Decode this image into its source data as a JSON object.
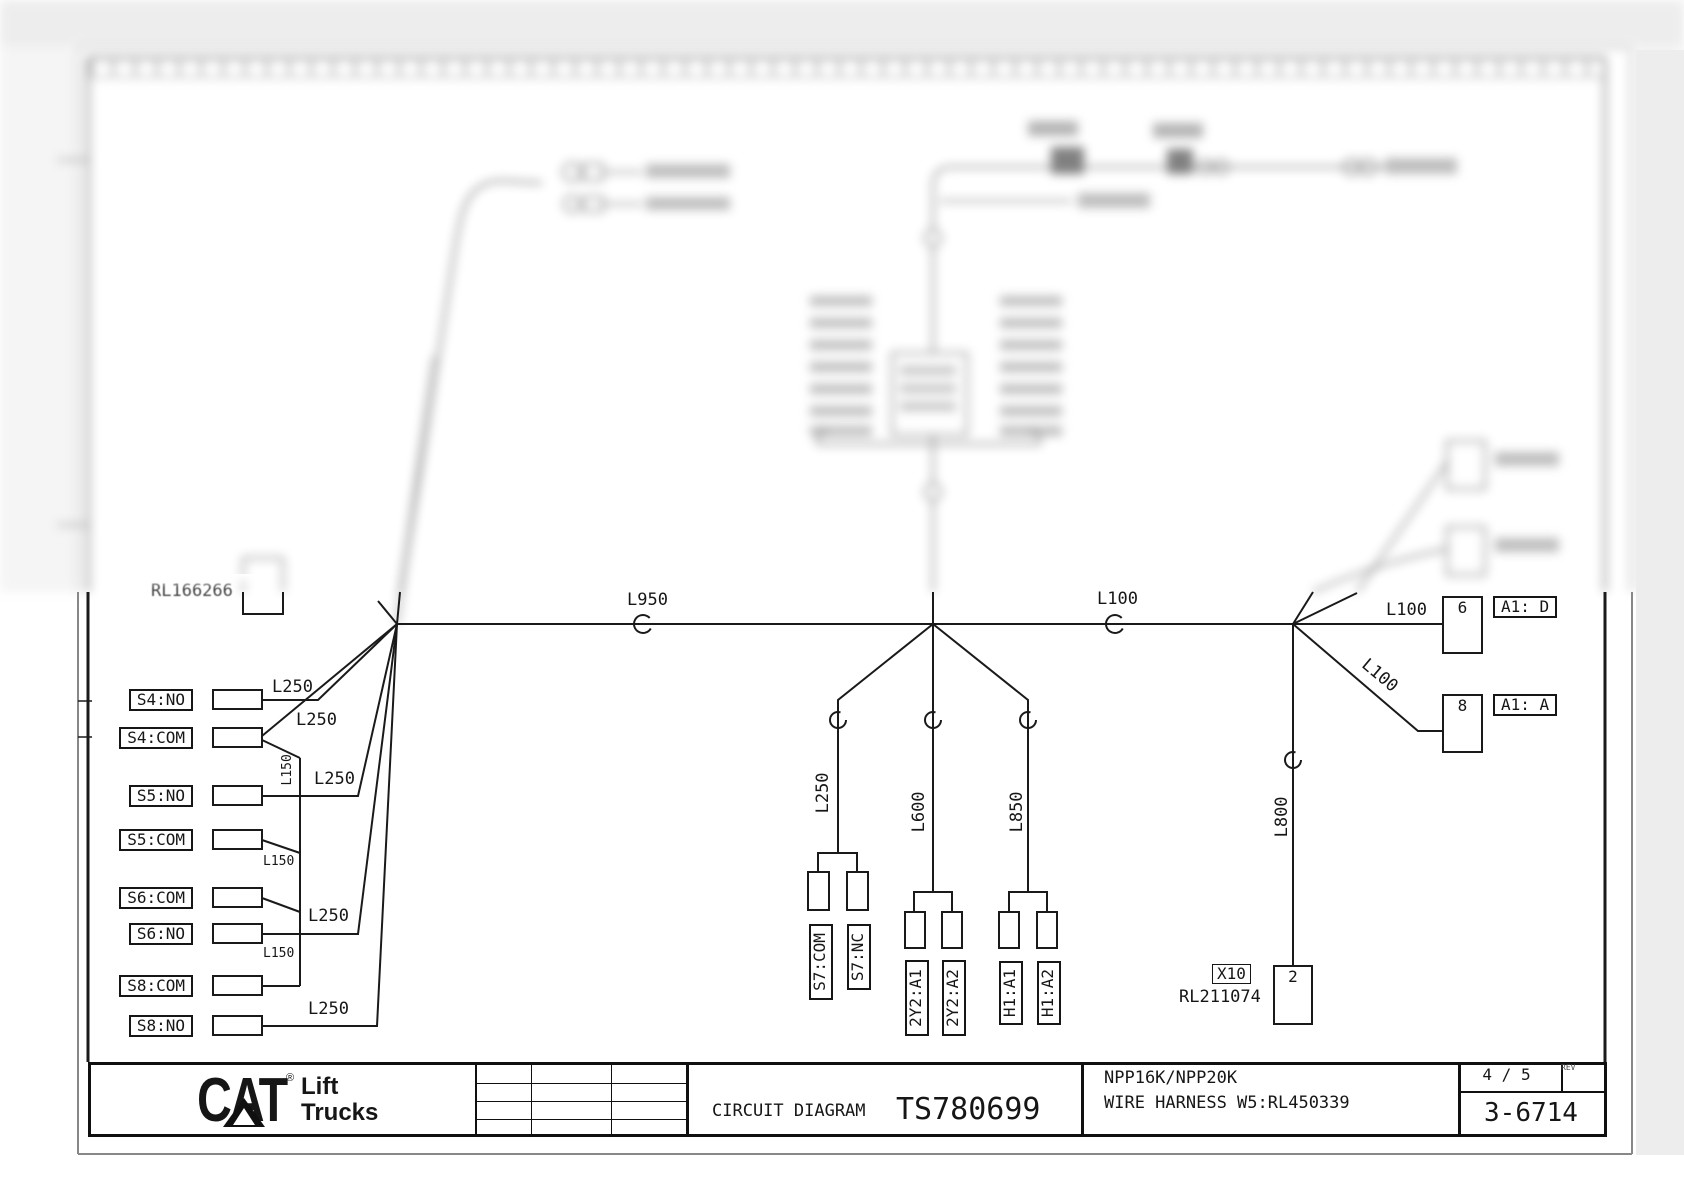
{
  "doc": {
    "partial_ref_left": "RL166266"
  },
  "title_block": {
    "logo": {
      "brand": "CAT",
      "reg": "®",
      "line1": "Lift",
      "line2": "Trucks"
    },
    "type_label": "CIRCUIT DIAGRAM",
    "number": "TS780699",
    "model": "NPP16K/NPP20K",
    "harness": "WIRE HARNESS W5:RL450339",
    "sheet": "4 / 5",
    "rev_label": "REV",
    "code": "3-6714"
  },
  "bus": {
    "left_wire": "L950",
    "right_wire": "L100"
  },
  "left_terminals": [
    {
      "label": "S4:NO",
      "wire": "L250"
    },
    {
      "label": "S4:COM",
      "wire": "L250",
      "jumper": "L150"
    },
    {
      "label": "S5:NO",
      "wire": "L250"
    },
    {
      "label": "S5:COM",
      "jumper": "L150"
    },
    {
      "label": "S6:COM",
      "jumper": "L150"
    },
    {
      "label": "S6:NO",
      "wire": "L250"
    },
    {
      "label": "S8:COM"
    },
    {
      "label": "S8:NO",
      "wire": "L250"
    }
  ],
  "drops": [
    {
      "wire": "L250",
      "pins": [
        "S7:COM",
        "S7:NC"
      ]
    },
    {
      "wire": "L600",
      "pins": [
        "2Y2:A1",
        "2Y2:A2"
      ]
    },
    {
      "wire": "L850",
      "pins": [
        "H1:A1",
        "H1:A2"
      ]
    }
  ],
  "right_branch": {
    "top_wire": "L100",
    "diag_wire": "L100",
    "down_wire": "L800",
    "connector_top": {
      "pin": "6",
      "ref": "A1: D"
    },
    "connector_bottom": {
      "pin": "8",
      "ref": "A1: A"
    },
    "x10": {
      "label": "X10",
      "part": "RL211074",
      "pin": "2"
    }
  }
}
